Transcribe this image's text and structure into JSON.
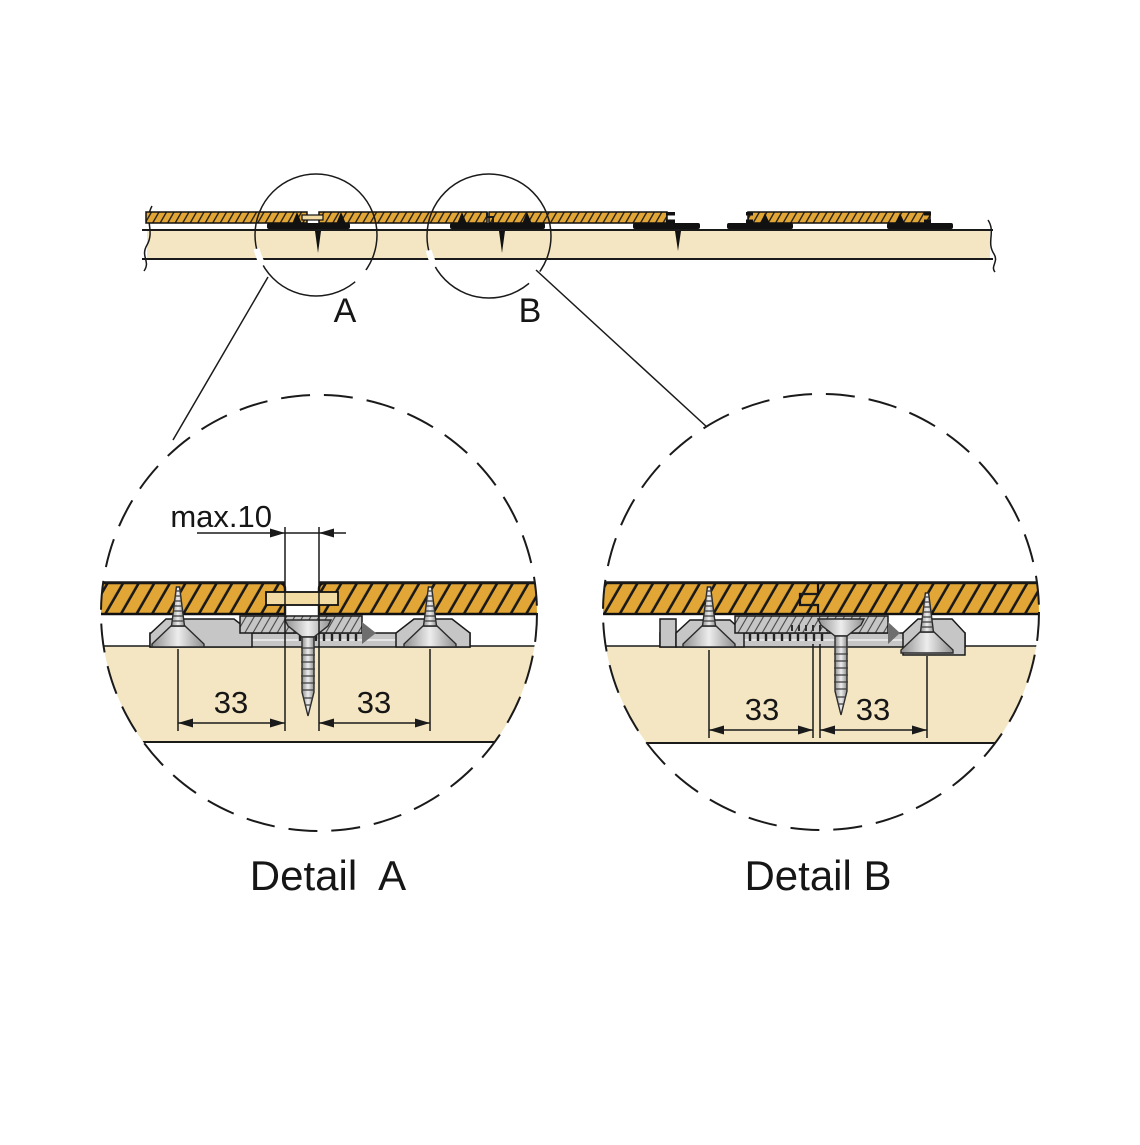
{
  "figure": {
    "top_view": {
      "callout_a": "A",
      "callout_b": "B"
    },
    "detail_a": {
      "title": "Detail  A",
      "gap_dim_label": "max.10",
      "left_dim": "33",
      "right_dim": "33"
    },
    "detail_b": {
      "title": "Detail B",
      "left_dim": "33",
      "right_dim": "33"
    },
    "colors": {
      "line_black": "#1a1a1a",
      "board_gold": "#e2a636",
      "connector_tan": "#f3dca4",
      "joist_beige": "#f4e6c2",
      "clip_gray": "#c6c6c6",
      "clip_gray_dark": "#6e6e6e",
      "screw_silver_light": "#ededed",
      "screw_silver_dark": "#8f8f8f"
    }
  }
}
